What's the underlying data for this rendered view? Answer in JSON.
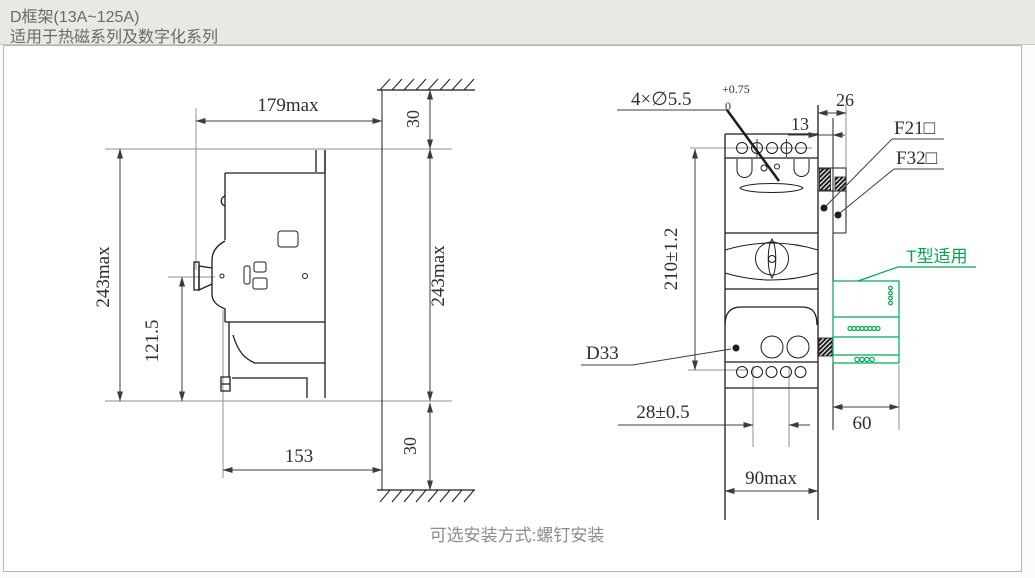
{
  "header": {
    "title": "D框架(13A~125A)",
    "subtitle": "适用于热磁系列及数字化系列"
  },
  "caption": "可选安装方式:螺钉安装",
  "colors": {
    "accent_green": "#00a651",
    "outline": "#1c1c1c",
    "construction_gray": "#909090",
    "header_bg": "#e9e8e4",
    "header_text": "#6b6a64",
    "caption_text": "#8c8c8c"
  },
  "side_view": {
    "width_max": "179max",
    "height_max_left": "243max",
    "height_max_right": "243max",
    "handle_center_height": "121.5",
    "depth": "153",
    "top_clearance": "30",
    "bottom_clearance": "30"
  },
  "front_view": {
    "mounting_holes": "4×∅5.5",
    "mounting_holes_tol_upper": "+0.75",
    "mounting_holes_tol_lower": "0",
    "bracket_offset": "13",
    "bracket_depth": "26",
    "accessory_f21": "F21□",
    "accessory_f32": "F32□",
    "t_type_note": "T型适用",
    "model_label": "D33",
    "hole_pitch": "28±0.5",
    "height_tol": "210±1.2",
    "width_max": "90max",
    "t_block_width": "60"
  }
}
